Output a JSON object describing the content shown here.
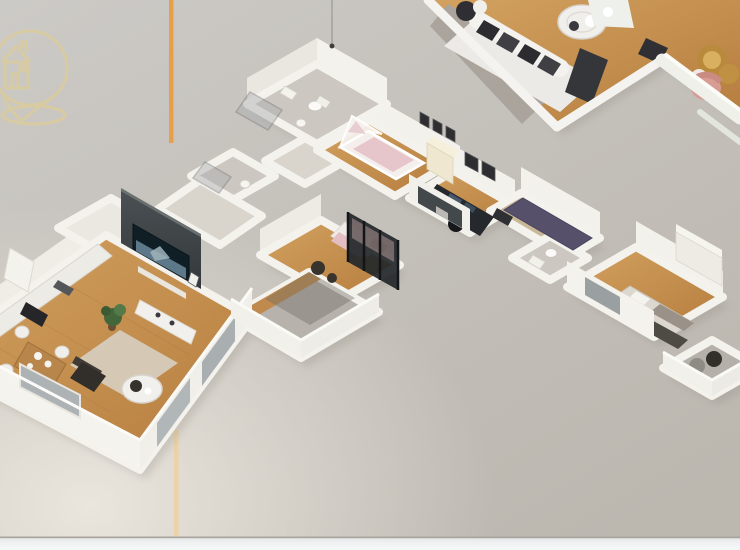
{
  "scene": {
    "type": "3d-floor-plan-render",
    "description": "Isometric dollhouse cutaway render of an apartment on a gray backdrop",
    "rooms": [
      "bathroom-main",
      "bathroom-second",
      "hallway",
      "nursery",
      "home-office",
      "corridor",
      "bathroom-small",
      "bedroom",
      "balcony",
      "bedroom-second",
      "terrace",
      "living-room",
      "kitchen",
      "dining-area",
      "detached-lounge-fragment"
    ],
    "icons": {
      "logo": "house-location-pin-icon"
    }
  },
  "colors": {
    "bg_top": "#cccac6",
    "bg_mid": "#c4c0ba",
    "bg_bottom": "#bcb7af",
    "bg_glow": "#ece8df",
    "bottom_bar": "#f0f1f2",
    "bottom_bar_line": "#a8a5a0",
    "accent_orange": "#e7a049",
    "accent_tan": "#ecd2a4",
    "logo_gold": "#ddcc96",
    "wall": "#f4f2ed",
    "wall_lit": "#eae7e1",
    "wall_shadow": "#8f8a80",
    "wood_light": "#d3a260",
    "wood_dark": "#b57c3e",
    "tile": "#ccc7c0",
    "light_floor": "#d9d5cd",
    "tv_wall_top": "#4a5053",
    "tv_wall_bottom": "#33383b",
    "tv_screen": "#101e26",
    "tv_picture": "#5d7888",
    "purple_rug": "#57506b",
    "crib_pink": "#e6c6ca",
    "pink_chair": "#d79d94",
    "gold_table": "#b98a3c",
    "dark_furniture": "#2c2c30",
    "glass": "#a9aeb0",
    "balcony_floor": "#b5b1aa"
  }
}
